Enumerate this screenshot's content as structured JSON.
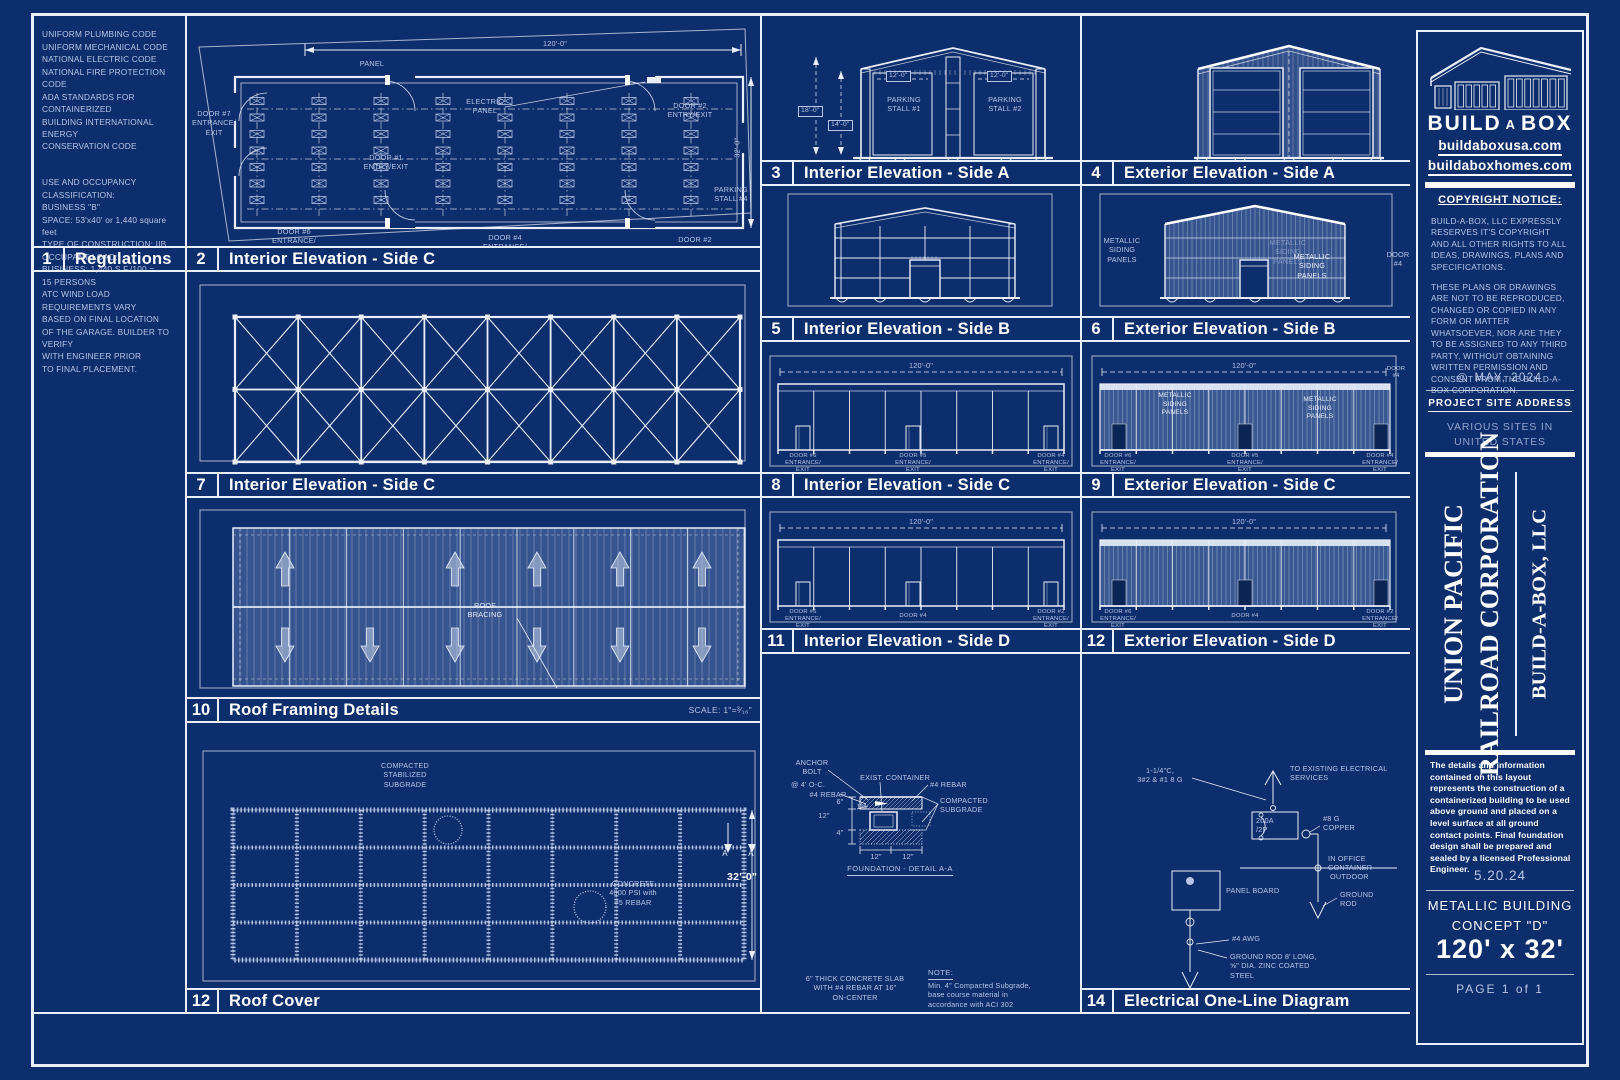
{
  "colors": {
    "bg": "#0d2e6d",
    "ink": "#e9eef8",
    "bright": "#ffffff",
    "dim": "#b7c5e6",
    "dimmer": "#8fa3cc",
    "siding": "#6883b9",
    "door_dark": "#0a2453"
  },
  "regulations": {
    "number": "1",
    "title": "Regulations",
    "codes": "UNIFORM PLUMBING CODE\nUNIFORM MECHANICAL CODE\nNATIONAL ELECTRIC CODE\nNATIONAL FIRE PROTECTION CODE\nADA STANDARDS FOR CONTAINERIZED\nBUILDING INTERNATIONAL ENERGY\nCONSERVATION CODE",
    "occupancy": "USE AND OCCUPANCY CLASSIFICATION:\nBUSINESS \"B\"\nSPACE: 53'x40' or 1,440 square feet\nTYPE OF CONSTRUCTION: IIB\nOCCUPANT LOAD:\n        BUSINESS: 1,440 S.F./100 =\n15 PERSONS\nATC WIND LOAD REQUIREMENTS VARY\nBASED ON FINAL LOCATION\nOF THE GARAGE.  BUILDER TO VERIFY\nWITH ENGINEER PRIOR\nTO FINAL PLACEMENT."
  },
  "panels": {
    "plan": {
      "number": "2",
      "title": "Interior Elevation - Side C",
      "dim_w": "120'-0\"",
      "dim_h": "32'-0\"",
      "panel": "PANEL",
      "electric": "ELECTRIC\nPANEL",
      "door7": "DOOR #7\nENTRANCE/\nEXIT",
      "door1": "DOOR #1\nENTRY/EXIT",
      "door2t": "DOOR #2\nENTRY/EXIT",
      "stall4": "PARKING\nSTALL #4",
      "door6": "DOOR #6\nENTRANCE/\nEXIT",
      "door4": "DOOR #4\nENTRANCE/\nEXIT",
      "door2b": "DOOR #2"
    },
    "truss": {
      "number": "7",
      "title": "Interior Elevation - Side C"
    },
    "roof": {
      "number": "10",
      "title": "Roof Framing Details",
      "scale": "SCALE:  1\"=³⁄₁₆\"",
      "label": "ROOF\nBRACING"
    },
    "slab": {
      "number": "12",
      "title": "Roof Cover",
      "subgrade": "COMPACTED\nSTABILIZED\nSUBGRADE",
      "concrete": "CONCRETE\n4000 PSI with\n#5 REBAR",
      "dim_h": "32'-0\"",
      "marker_a1": "A",
      "marker_a2": "A",
      "note1": "6\" THICK CONCRETE SLAB\nWITH #4 REBAR AT 16\"\nON-CENTER",
      "note2_head": "NOTE:",
      "note2": "Min. 4\" Compacted Subgrade,\nbase course material in\naccordance with ACI 302"
    },
    "elevA_int": {
      "number": "3",
      "title": "Interior Elevation - Side A",
      "dim18": "18'-0\"",
      "dim14": "14'-0\"",
      "dim12a": "12'-0\"",
      "dim12b": "12'-0\"",
      "stall1": "PARKING\nSTALL #1",
      "stall2": "PARKING\nSTALL #2"
    },
    "elevA_ext": {
      "number": "4",
      "title": "Exterior Elevation - Side A"
    },
    "elevB_int": {
      "number": "5",
      "title": "Interior Elevation - Side B"
    },
    "elevB_ext": {
      "number": "6",
      "title": "Exterior Elevation - Side B",
      "siding1": "METALLIC\nSIDING\nPANELS",
      "siding2": "METALLIC\nSIDING\nPANELS",
      "door4": "DOOR\n#4"
    },
    "elevC_int": {
      "number": "8",
      "title": "Interior Elevation - Side C",
      "dim": "120'-0\"",
      "doorL": "DOOR #6\nENTRANCE/\nEXIT",
      "doorM": "DOOR #5\nENTRANCE/\nEXIT",
      "doorR": "DOOR #4\nENTRANCE/\nEXIT"
    },
    "elevC_ext": {
      "number": "9",
      "title": "Exterior Elevation - Side C",
      "dim": "120'-0\"",
      "siding1": "METALLIC\nSIDING\nPANELS",
      "siding2": "METALLIC\nSIDING\nPANELS",
      "door4": "DOOR\n#4",
      "doorL": "DOOR #6\nENTRANCE/\nEXIT",
      "doorM": "DOOR #5\nENTRANCE/\nEXIT",
      "doorR": "DOOR #4\nENTRANCE/\nEXIT"
    },
    "elevD_int": {
      "number": "11",
      "title": "Interior Elevation - Side D",
      "dim": "120'-0\"",
      "doorL": "DOOR #6\nENTRANCE/\nEXIT",
      "doorM": "DOOR #4",
      "doorR": "DOOR #2\nENTRANCE/\nEXIT"
    },
    "elevD_ext": {
      "number": "12",
      "title": "Exterior Elevation - Side D",
      "dim": "120'-0\"",
      "doorL": "DOOR #6\nENTRANCE/\nEXIT",
      "doorM": "DOOR #4",
      "doorR": "DOOR #2\nENTRANCE/\nEXIT"
    },
    "detailAA": {
      "anchor": "ANCHOR\nBOLT",
      "oc": "@ 4' O-C.",
      "rebar1": "#4 REBAR",
      "exist": "EXIST. CONTAINER",
      "rebar2": "#4 REBAR",
      "compacted": "COMPACTED\nSUBGRADE",
      "d6": "6\"",
      "d12a": "12\"",
      "d4": "4\"",
      "slope": "1%",
      "d12b": "12\"",
      "d12c": "12\"",
      "caption": "FOUNDATION - DETAIL A-A"
    },
    "electrical": {
      "number": "14",
      "title": "Electrical One-Line Diagram",
      "feeder": "1-1/4\"C,\n3#2 & #1 8 G",
      "to_services": "TO EXISTING ELECTRICAL\nSERVICES",
      "breaker": "200A\n/2P",
      "copper": "#8 G\nCOPPER",
      "office": "IN OFFICE CONTAINER",
      "outdoor": "OUTDOOR",
      "panel_board": "PANEL BOARD",
      "ground_rod": "GROUND\nROD",
      "awg": "#4 AWG",
      "rod_spec": "GROUND ROD 8' LONG,\n⅝\" DIA. ZINC COATED\nSTEEL"
    }
  },
  "titleblock": {
    "brand_pre": "BUILD",
    "brand_a": "A",
    "brand_post": "BOX",
    "site1": "buildaboxusa.com",
    "site2": "buildaboxhomes.com",
    "copyright_heading": "COPYRIGHT NOTICE:",
    "copyright_p1": "BUILD-A-BOX, LLC EXPRESSLY RESERVES  IT'S COPYRIGHT AND ALL OTHER RIGHTS TO ALL IDEAS, DRAWINGS, PLANS AND SPECIFICATIONS.",
    "copyright_p2": "THESE PLANS OR DRAWINGS ARE NOT TO BE REPRODUCED, CHANGED OR COPIED IN ANY FORM OR MATTER WHATSOEVER, NOR ARE THEY TO BE ASSIGNED TO ANY THIRD PARTY, WITHOUT OBTAINING WRITTEN PERMISSION AND CONSENT FROM THE BUILD-A-BOX CORPORATION.",
    "copyright_icon": "©",
    "copyright_date": "MAY, 2024",
    "psa_heading": "PROJECT SITE ADDRESS",
    "psa_value": "VARIOUS SITES IN\nUNITED STATES",
    "client1": "UNION PACIFIC",
    "client2": "RAILROAD CORPORATION",
    "company": "BUILD-A-BOX, LLC",
    "disclaimer": "The details and information contained on this layout represents the construction of a containerized building to be used above ground and placed on a level surface at all ground contact points.  Final foundation design shall be prepared and sealed by a licensed Professional Engineer.",
    "date": "5.20.24",
    "concept": "METALLIC BUILDING\nCONCEPT \"D\"",
    "size": "120' x 32'",
    "page": "PAGE 1 of 1"
  }
}
